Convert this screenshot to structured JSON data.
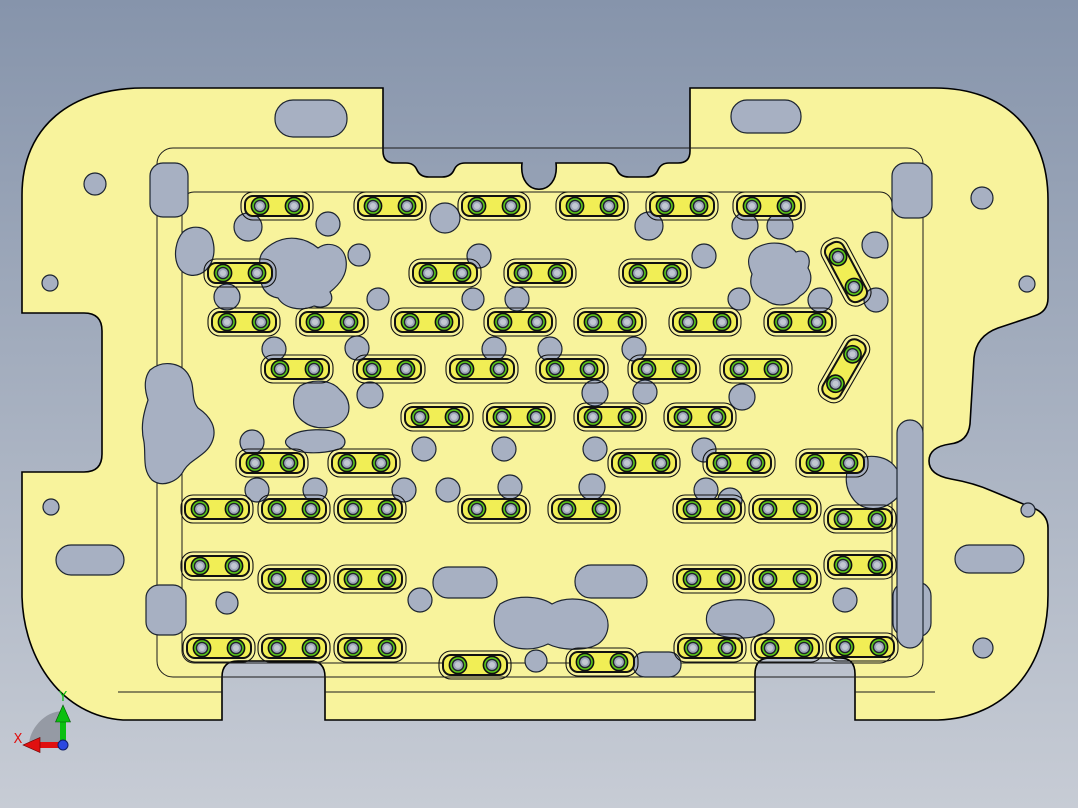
{
  "scene": {
    "type": "cad-3d-viewport",
    "description": "Top view of a yellow machined fixture plate with many clamp strips, screw heads, circular holes, slotted holes and irregular pocket cutouts on a gradient CAD background"
  },
  "viewport": {
    "width": 1078,
    "height": 808
  },
  "colors": {
    "background_top": "#8694ab",
    "background_bottom": "#c7ccd5",
    "plate": "#f8f39c",
    "plate_edge": "#000000",
    "contour_line": "#1a1a1a",
    "hole_fill": "#a7b0c2",
    "hole_edge": "#1c2430",
    "strip_fill": "#f1ee55",
    "strip_edge": "#111111",
    "screw_ring": "#5ccd17",
    "screw_body": "#9fa8ba",
    "screw_center": "#c2c8d2",
    "triad_x": "#e01010",
    "triad_y": "#0bbf10",
    "triad_z": "#2b47e0",
    "triad_fan": "#8a8f98"
  },
  "part": {
    "outer_path": "M143,88 L383,88 L383,151 Q383,163 395,163 L406,163 Q414,163 417,170 Q420,177 429,177 L442,177 Q451,177 454,170 Q457,163 465,163 L522,163 C518,198 560,198 556,163 L606,163 Q614,163 617,170 Q620,177 629,177 L646,177 Q655,177 658,170 Q661,163 669,163 L678,163 Q690,163 690,151 L690,88 L935,88 C1005,88 1048,131 1048,200 L1048,298 Q1048,312 1034,316 L998,328 Q976,336 974,358 L970,424 Q968,442 950,444 Q929,447 929,461 Q929,475 951,479 Q974,483 992,491 L1028,506 Q1048,512 1048,528 L1048,595 C1048,668 1005,718 938,720 L855,720 L855,674 Q855,658 840,658 L770,658 Q755,658 755,674 L755,720 L325,720 L325,677 Q325,661 310,661 L238,661 Q222,661 222,677 L222,720 L123,720 C62,716 24,660 22,597 L22,472 L84,472 Q102,472 102,454 L102,331 Q102,313 84,313 L22,313 L22,195 C22,126 72,88 143,88 Z",
    "pocket_outlines": [
      [
        157,
        148,
        766,
        529,
        16
      ],
      [
        182,
        192,
        710,
        471,
        12
      ]
    ],
    "step_lines": [
      [
        118,
        692,
        222,
        692
      ],
      [
        325,
        692,
        755,
        692
      ],
      [
        855,
        692,
        935,
        692
      ]
    ]
  },
  "features": {
    "strip_size": [
      64,
      20
    ],
    "strips": [
      [
        245,
        196
      ],
      [
        358,
        196
      ],
      [
        462,
        196
      ],
      [
        560,
        196
      ],
      [
        650,
        196
      ],
      [
        737,
        196
      ],
      [
        208,
        263
      ],
      [
        413,
        263
      ],
      [
        508,
        263
      ],
      [
        623,
        263
      ],
      [
        212,
        312
      ],
      [
        300,
        312
      ],
      [
        395,
        312
      ],
      [
        488,
        312
      ],
      [
        578,
        312
      ],
      [
        673,
        312
      ],
      [
        768,
        312
      ],
      [
        265,
        359
      ],
      [
        357,
        359
      ],
      [
        450,
        359
      ],
      [
        540,
        359
      ],
      [
        632,
        359
      ],
      [
        724,
        359
      ],
      [
        405,
        407
      ],
      [
        487,
        407
      ],
      [
        578,
        407
      ],
      [
        668,
        407
      ],
      [
        240,
        453
      ],
      [
        332,
        453
      ],
      [
        612,
        453
      ],
      [
        707,
        453
      ],
      [
        800,
        453
      ],
      [
        185,
        499
      ],
      [
        262,
        499
      ],
      [
        338,
        499
      ],
      [
        462,
        499
      ],
      [
        552,
        499
      ],
      [
        677,
        499
      ],
      [
        753,
        499
      ],
      [
        828,
        509
      ],
      [
        185,
        556
      ],
      [
        262,
        569
      ],
      [
        338,
        569
      ],
      [
        677,
        569
      ],
      [
        753,
        569
      ],
      [
        828,
        555
      ],
      [
        187,
        638
      ],
      [
        262,
        638
      ],
      [
        338,
        638
      ],
      [
        443,
        655
      ],
      [
        570,
        652
      ],
      [
        678,
        638
      ],
      [
        755,
        638
      ],
      [
        830,
        637
      ]
    ],
    "diagonal_strips": [
      [
        846,
        272,
        62
      ],
      [
        844,
        369,
        -60
      ]
    ],
    "circles": [
      [
        95,
        184,
        11
      ],
      [
        50,
        283,
        8
      ],
      [
        51,
        507,
        8
      ],
      [
        982,
        198,
        11
      ],
      [
        1027,
        284,
        8
      ],
      [
        1028,
        510,
        7
      ],
      [
        983,
        648,
        10
      ],
      [
        248,
        227,
        14
      ],
      [
        328,
        224,
        12
      ],
      [
        445,
        218,
        15
      ],
      [
        649,
        226,
        14
      ],
      [
        745,
        226,
        13
      ],
      [
        780,
        226,
        13
      ],
      [
        875,
        245,
        13
      ],
      [
        359,
        255,
        11
      ],
      [
        479,
        256,
        12
      ],
      [
        704,
        256,
        12
      ],
      [
        227,
        297,
        13
      ],
      [
        378,
        299,
        11
      ],
      [
        473,
        299,
        11
      ],
      [
        517,
        299,
        12
      ],
      [
        739,
        299,
        11
      ],
      [
        820,
        300,
        12
      ],
      [
        876,
        300,
        12
      ],
      [
        274,
        349,
        12
      ],
      [
        357,
        348,
        12
      ],
      [
        494,
        349,
        12
      ],
      [
        550,
        349,
        12
      ],
      [
        634,
        349,
        12
      ],
      [
        370,
        395,
        13
      ],
      [
        595,
        393,
        13
      ],
      [
        645,
        392,
        12
      ],
      [
        742,
        397,
        13
      ],
      [
        252,
        442,
        12
      ],
      [
        424,
        449,
        12
      ],
      [
        504,
        449,
        12
      ],
      [
        595,
        449,
        12
      ],
      [
        704,
        450,
        12
      ],
      [
        257,
        490,
        12
      ],
      [
        315,
        490,
        12
      ],
      [
        404,
        490,
        12
      ],
      [
        448,
        490,
        12
      ],
      [
        510,
        487,
        12
      ],
      [
        592,
        487,
        13
      ],
      [
        706,
        490,
        12
      ],
      [
        730,
        500,
        12
      ],
      [
        227,
        603,
        11
      ],
      [
        420,
        600,
        12
      ],
      [
        845,
        600,
        12
      ],
      [
        536,
        661,
        11
      ]
    ],
    "slots": [
      [
        275,
        100,
        72,
        37,
        18
      ],
      [
        731,
        100,
        70,
        33,
        16
      ],
      [
        892,
        163,
        40,
        55,
        13
      ],
      [
        150,
        163,
        38,
        54,
        13
      ],
      [
        56,
        545,
        68,
        30,
        15
      ],
      [
        955,
        545,
        69,
        28,
        14
      ],
      [
        433,
        567,
        64,
        31,
        15
      ],
      [
        575,
        565,
        72,
        33,
        16
      ],
      [
        146,
        585,
        40,
        50,
        13
      ],
      [
        893,
        582,
        38,
        55,
        14
      ],
      [
        633,
        652,
        48,
        25,
        12
      ],
      [
        897,
        420,
        26,
        228,
        13
      ]
    ],
    "blobs": [
      "M183,232 C192,224 208,226 212,238 C216,250 214,262 206,270 C196,279 183,276 178,266 C173,255 176,240 183,232 Z",
      "M272,244 C288,234 306,238 318,248 C330,240 344,246 346,260 C348,274 340,284 330,292 C336,302 326,310 314,306 C300,312 284,308 278,298 C266,296 258,286 262,272 C256,258 262,250 272,244 Z",
      "M300,386 C314,378 332,380 340,390 C350,398 352,412 344,420 C334,430 314,430 304,422 C292,414 290,396 300,386 Z",
      "M150,370 C162,360 180,362 188,374 C196,386 190,398 198,408 C210,416 218,428 212,442 C206,456 192,458 184,470 C178,482 162,488 152,480 C142,470 146,456 144,442 C140,426 144,412 148,400 C144,388 144,378 150,370 Z",
      "M756,248 C770,240 788,242 796,252 C806,248 812,258 808,268 C814,278 810,290 800,296 C792,306 776,308 766,300 C754,296 748,286 752,274 C746,262 748,254 756,248 Z",
      "M500,604 C516,594 540,596 552,604 C566,596 590,598 600,608 C612,618 610,636 598,644 C584,652 560,650 548,644 C532,652 512,650 502,640 C492,630 492,614 500,604 Z",
      "M712,606 C726,598 750,598 762,604 C774,610 778,622 770,630 C758,640 730,640 716,634 C704,628 704,614 712,606 Z",
      "M290,436 C302,428 330,428 340,434 C348,440 346,448 336,450 C320,454 300,454 290,448 C284,444 284,440 290,436 Z",
      "M852,462 C868,452 888,456 896,468 C906,478 904,494 892,502 C880,512 862,510 854,500 C844,488 844,472 852,462 Z"
    ]
  },
  "triad": {
    "labels": {
      "x": "X",
      "y": "Y"
    },
    "origin": [
      63,
      745
    ],
    "x_shaft_end": [
      40,
      745
    ],
    "x_tip": [
      23,
      745
    ],
    "y_shaft_end": [
      63,
      722
    ],
    "y_tip": [
      63,
      705
    ],
    "fan_radius": 34
  }
}
